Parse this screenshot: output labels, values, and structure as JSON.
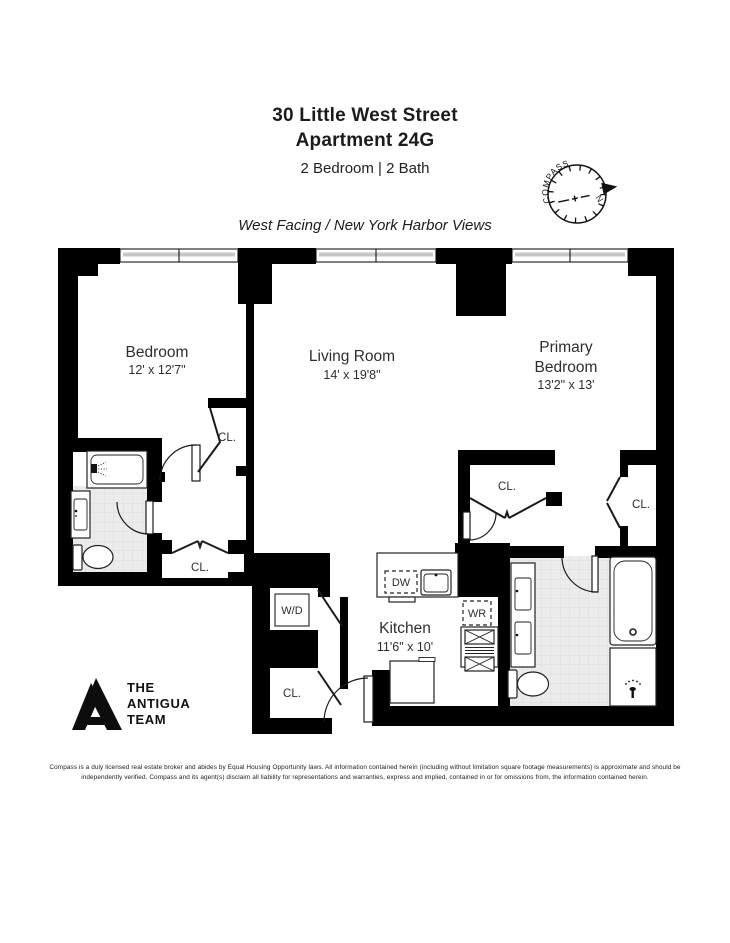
{
  "header": {
    "address_line1": "30 Little West Street",
    "address_line2": "Apartment 24G",
    "specs": "2 Bedroom | 2 Bath",
    "tagline": "West Facing / New York Harbor Views"
  },
  "compass": {
    "label": "COMPASS",
    "north": "N"
  },
  "floorplan": {
    "rooms": {
      "bedroom": {
        "name": "Bedroom",
        "dims": "12' x 12'7\""
      },
      "living_room": {
        "name": "Living Room",
        "dims": "14' x 19'8\""
      },
      "primary_bedroom": {
        "name_line1": "Primary",
        "name_line2": "Bedroom",
        "dims": "13'2\" x 13'"
      },
      "kitchen": {
        "name": "Kitchen",
        "dims": "11'6\" x 10'"
      }
    },
    "labels": {
      "closet": "CL.",
      "washer_dryer": "W/D",
      "dishwasher": "DW",
      "wine_cooler": "WR"
    }
  },
  "logo": {
    "line1": "THE",
    "line2": "ANTIGUA",
    "line3": "TEAM"
  },
  "disclaimer": "Compass is a duly licensed real estate broker and abides by Equal Housing Opportunity laws. All information contained herein (including without limitation square footage measurements) is approximate and should be independently verified. Compass and its agent(s) disclaim all liability for representations and warranties, express and implied, contained in or for omissions from, the information contained herein.",
  "colors": {
    "wall": "#000000",
    "tile_fill": "#ececec",
    "tile_grid": "#d9d9d9"
  }
}
